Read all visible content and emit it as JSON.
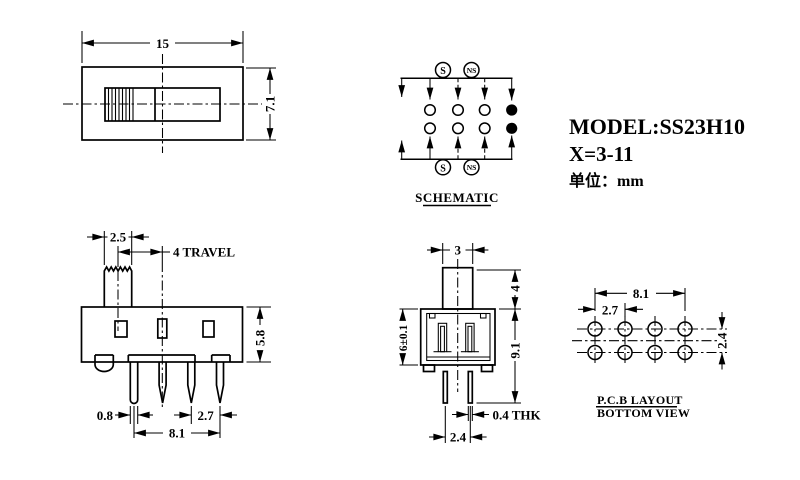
{
  "title": {
    "model": "MODEL:SS23H10",
    "x_range": "X=3-11",
    "unit": "单位：mm"
  },
  "top_view": {
    "width": "15",
    "height": "7.1"
  },
  "schematic": {
    "caption": "SCHEMATIC",
    "s": "S",
    "ns": "NS"
  },
  "front_view": {
    "knob_width": "2.5",
    "travel": "4 TRAVEL",
    "body_height": "5.8",
    "pin_width": "0.8",
    "pin_pitch": "2.7",
    "pin_span": "8.1"
  },
  "side_view": {
    "knob_depth": "3",
    "knob_height": "4",
    "body_height": "6±0.1",
    "overall_height": "9.1",
    "pin_thickness": "0.4 THK",
    "pin_gap": "2.4"
  },
  "pcb_view": {
    "caption_line1": "P.C.B LAYOUT",
    "caption_line2": "BOTTOM VIEW",
    "hole_span": "8.1",
    "hole_pitch": "2.7",
    "row_gap": "2.4"
  },
  "colors": {
    "line": "#000000",
    "background": "#ffffff"
  }
}
